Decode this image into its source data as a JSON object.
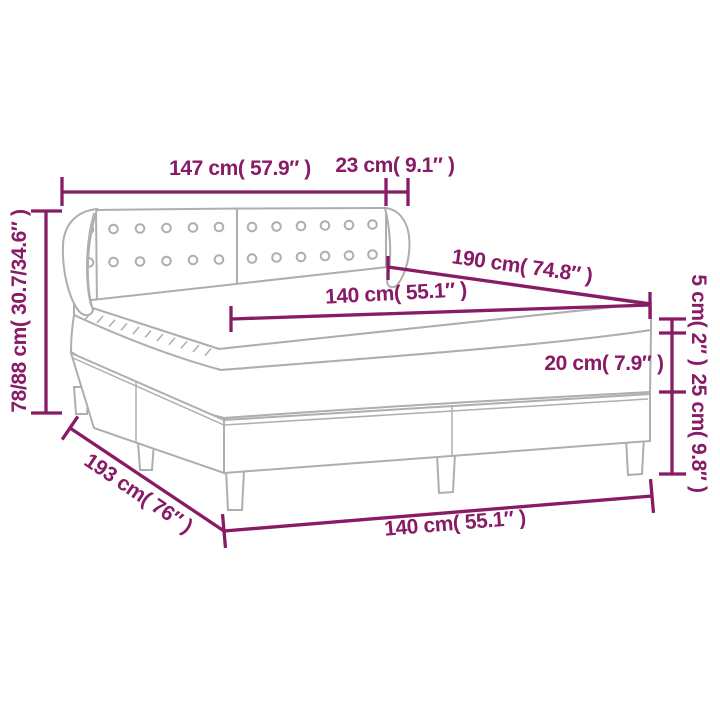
{
  "diagram": {
    "type": "product-dimension-diagram",
    "subject": "box spring bed with tufted headboard, mattress topper and legs",
    "colors": {
      "dimension_accent": "#881a66",
      "drawing_line": "#aeaeae"
    },
    "labels": {
      "headboard_width": "147 cm( 57.9″ )",
      "wing_depth": "23 cm( 9.1″ )",
      "mattress_length": "190 cm( 74.8″ )",
      "mattress_width": "140 cm( 55.1″ )",
      "topper_height": "5 cm( 2″ )",
      "mattress_height": "20 cm( 7.9″ )",
      "base_height": "25 cm( 9.8″ )",
      "overall_height": "78/88 cm( 30.7/34.6″ )",
      "base_length": "193 cm( 76″ )",
      "base_width": "140 cm( 55.1″ )"
    },
    "tufting": {
      "panels": 2,
      "rows_per_panel": 2,
      "buttons_per_row": 6
    }
  }
}
